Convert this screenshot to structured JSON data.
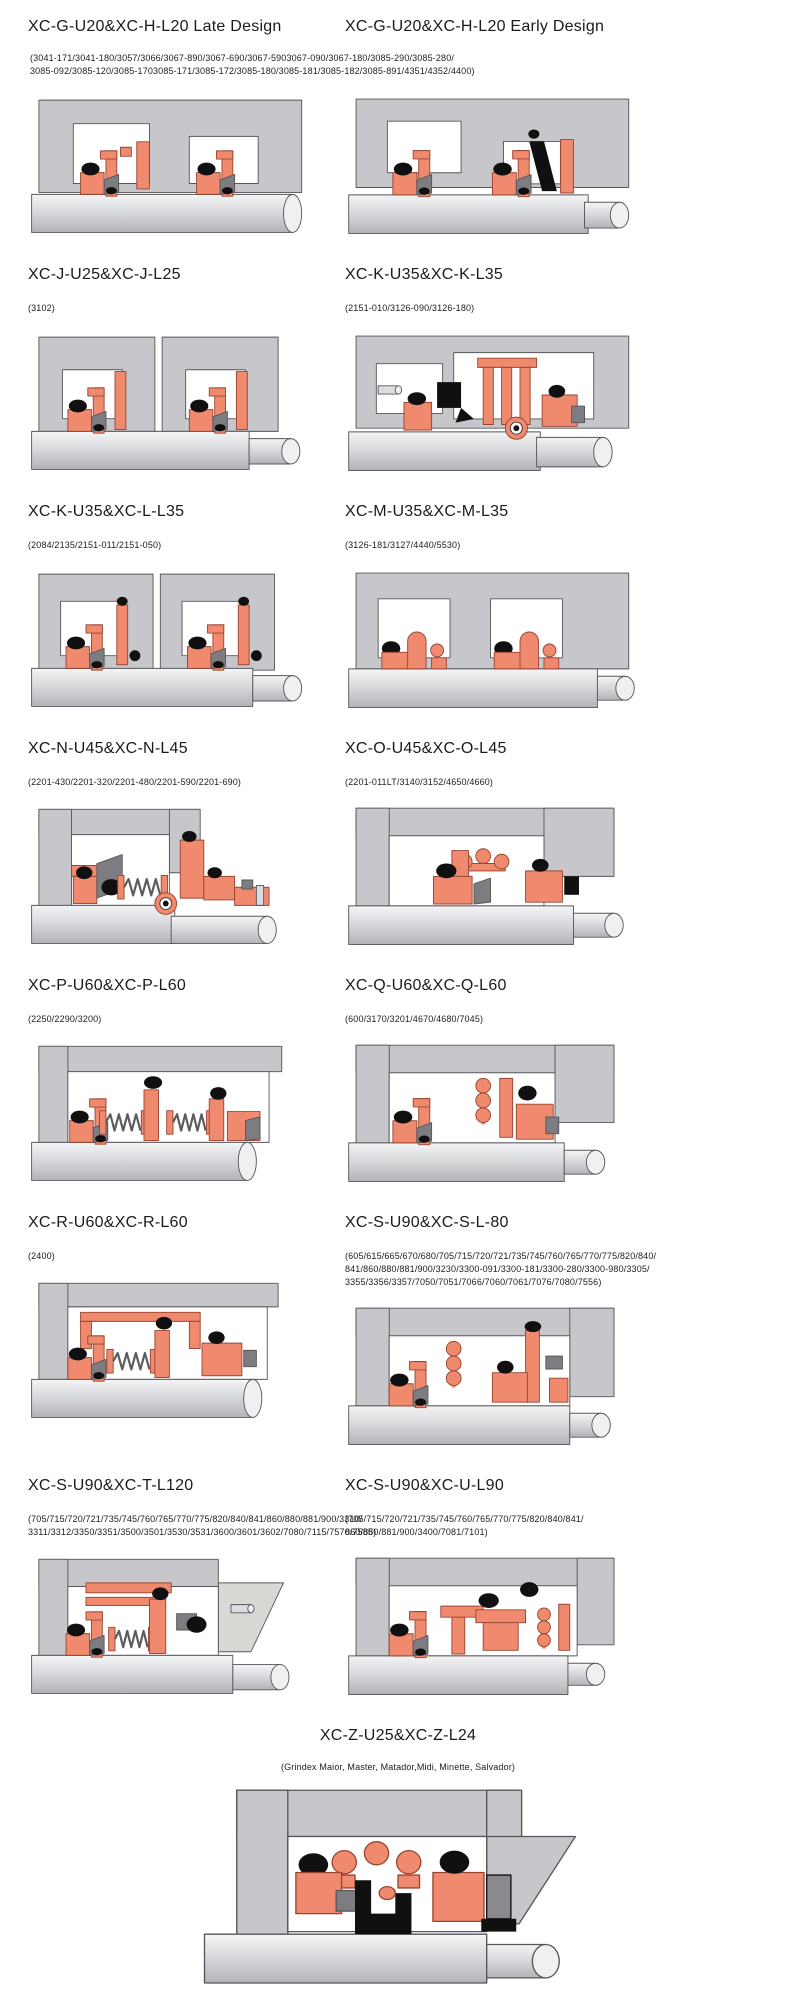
{
  "colors": {
    "housing_gray": "#c7c7cb",
    "cavity_white": "#ffffff",
    "component_orange": "#f08a6e",
    "component_orange_outline": "#9a4430",
    "elastomer_black": "#101010",
    "wedge_gray": "#7d7d81",
    "slide_gray": "#d8d9d4",
    "shaft_light": "#f4f5f6",
    "shaft_mid": "#d9dadd",
    "shaft_dark": "#b2b3b7",
    "outline_gray": "#56565a",
    "text": "#1a1a1a"
  },
  "rows": [
    {
      "type": "shared",
      "left": {
        "title": "XC-G-U20&XC-H-L20 Late Design",
        "diagram": "seal-xc-g-late"
      },
      "right": {
        "title": "XC-G-U20&XC-H-L20 Early Design",
        "diagram": "seal-xc-g-early"
      },
      "parts": [
        "(3041-171/3041-180/3057/3066/3067-890/3067-690/3067-5903067-090/3067-180/3085-290/3085-280/",
        "3085-092/3085-120/3085-1703085-171/3085-172/3085-180/3085-181/3085-182/3085-891/4351/4352/4400)"
      ]
    },
    {
      "type": "pair",
      "left": {
        "title": "XC-J-U25&XC-J-L25",
        "parts": [
          "(3102)"
        ],
        "diagram": "seal-xc-j"
      },
      "right": {
        "title": "XC-K-U35&XC-K-L35",
        "parts": [
          "(2151-010/3126-090/3126-180)"
        ],
        "diagram": "seal-xc-k"
      }
    },
    {
      "type": "pair",
      "left": {
        "title": "XC-K-U35&XC-L-L35",
        "parts": [
          "(2084/2135/2151-011/2151-050)"
        ],
        "diagram": "seal-xc-l"
      },
      "right": {
        "title": "XC-M-U35&XC-M-L35",
        "parts": [
          "(3126-181/3127/4440/5530)"
        ],
        "diagram": "seal-xc-m"
      }
    },
    {
      "type": "pair",
      "left": {
        "title": "XC-N-U45&XC-N-L45",
        "parts": [
          "(2201-430/2201-320/2201-480/2201-590/2201-690)"
        ],
        "diagram": "seal-xc-n"
      },
      "right": {
        "title": "XC-O-U45&XC-O-L45",
        "parts": [
          "(2201-011LT/3140/3152/4650/4660)"
        ],
        "diagram": "seal-xc-o"
      }
    },
    {
      "type": "pair",
      "left": {
        "title": "XC-P-U60&XC-P-L60",
        "parts": [
          "(2250/2290/3200)"
        ],
        "diagram": "seal-xc-p"
      },
      "right": {
        "title": "XC-Q-U60&XC-Q-L60",
        "parts": [
          "(600/3170/3201/4670/4680/7045)"
        ],
        "diagram": "seal-xc-q"
      }
    },
    {
      "type": "pair",
      "left": {
        "title": "XC-R-U60&XC-R-L60",
        "parts": [
          "(2400)"
        ],
        "diagram": "seal-xc-r"
      },
      "right": {
        "title": "XC-S-U90&XC-S-L-80",
        "parts": [
          "(605/615/665/670/680/705/715/720/721/735/745/760/765/770/775/820/840/",
          "841/860/880/881/900/3230/3300-091/3300-181/3300-280/3300-980/3305/",
          "3355/3356/3357/7050/7051/7066/7060/7061/7076/7080/7556)"
        ],
        "diagram": "seal-xc-s-l80"
      }
    },
    {
      "type": "pair",
      "left": {
        "title": "XC-S-U90&XC-T-L120",
        "parts": [
          "(705/715/720/721/735/745/760/765/770/775/820/840/841/860/880/881/900/3310/",
          "3311/3312/3350/3351/3500/3501/3530/3531/3600/3601/3602/7080/7115/7570/7585)"
        ],
        "diagram": "seal-xc-t"
      },
      "right": {
        "title": "XC-S-U90&XC-U-L90",
        "parts": [
          "(705/715/720/721/735/745/760/765/770/775/820/840/841/",
          "860/880/881/900/3400/7081/7101)"
        ],
        "diagram": "seal-xc-u"
      }
    },
    {
      "type": "center",
      "cell": {
        "title": "XC-Z-U25&XC-Z-L24",
        "parts": [
          "(Grindex Maior, Master, Matador,Midi, Minette, Salvador)"
        ],
        "diagram": "seal-xc-z"
      }
    }
  ]
}
